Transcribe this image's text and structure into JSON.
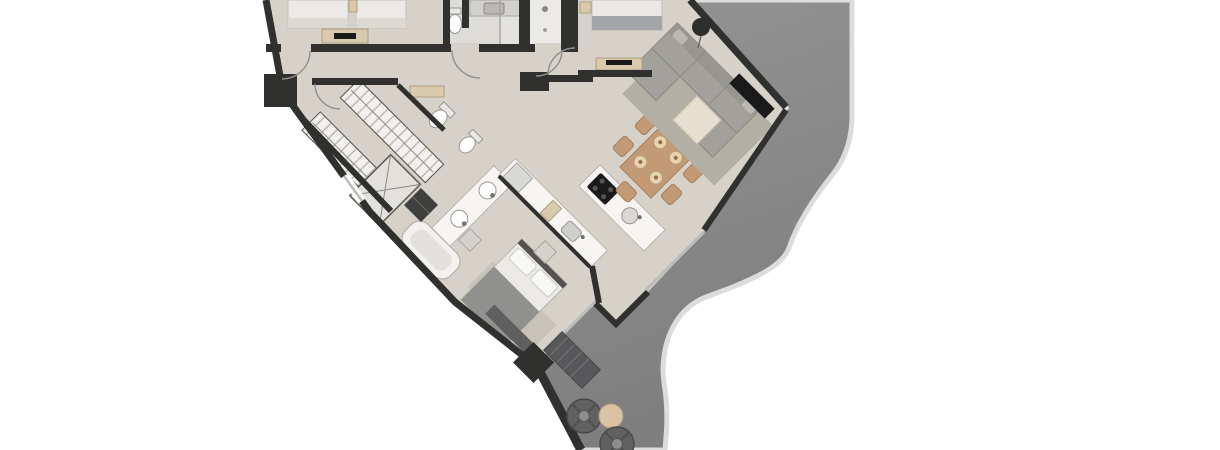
{
  "scene": {
    "description": "Aerial 3D rendered floor plan of a condominium unit, rotated 45 degrees and cropped at the top, with a gray wrap-around balcony on the right and lower-right",
    "background": "#ffffff"
  },
  "colors": {
    "floor": "#d6d2c9",
    "wall": "#30302e",
    "balcony": "#949494",
    "balcony_shade": "#7e7e7e",
    "balcony_edge": "#dcdcdc",
    "glass": "#bcbcbc",
    "arc": "#909090",
    "fixture_white": "#f6f5f2",
    "tan": "#d9c9ad",
    "wood": "#c29a76",
    "wood_dark": "#a87f5c",
    "sofa": "#a2a19c",
    "rug": "#b2b0a4",
    "bed_linen": "#eceae7",
    "blanket": "#90908e",
    "outdoor_dark": "#5c5c5c",
    "tv_black": "#1a1a1a"
  },
  "rooms": [
    {
      "name": "bedroom-top-left"
    },
    {
      "name": "bathroom-top"
    },
    {
      "name": "walk-in-shower-room"
    },
    {
      "name": "bedroom-top-right"
    },
    {
      "name": "living-room"
    },
    {
      "name": "dining-area"
    },
    {
      "name": "kitchen"
    },
    {
      "name": "walk-in-closet"
    },
    {
      "name": "master-bathroom"
    },
    {
      "name": "master-bedroom"
    },
    {
      "name": "hallway"
    },
    {
      "name": "wrap-around-balcony"
    }
  ],
  "furniture": {
    "living": [
      "sectional-sofa",
      "area-rug",
      "ottoman",
      "wall-tv",
      "floor-lamp"
    ],
    "dining": [
      "wood-table",
      "eight-chairs",
      "six-place-settings"
    ],
    "kitchen": [
      "island-with-cooktop-and-sink",
      "counter-run-with-fridge",
      "sink"
    ],
    "master_bedroom": [
      "double-bed",
      "foot-bench",
      "nightstands",
      "rug"
    ],
    "bedrooms": [
      "twin-beds",
      "tv-dresser",
      "double-bed",
      "media-console"
    ],
    "bathrooms": [
      "shower",
      "double-vanity",
      "bathtub",
      "toilet",
      "bidet",
      "laundry-unit"
    ],
    "balcony": [
      "two-round-lounge-chairs",
      "round-side-table",
      "slatted-outdoor-bench"
    ]
  }
}
